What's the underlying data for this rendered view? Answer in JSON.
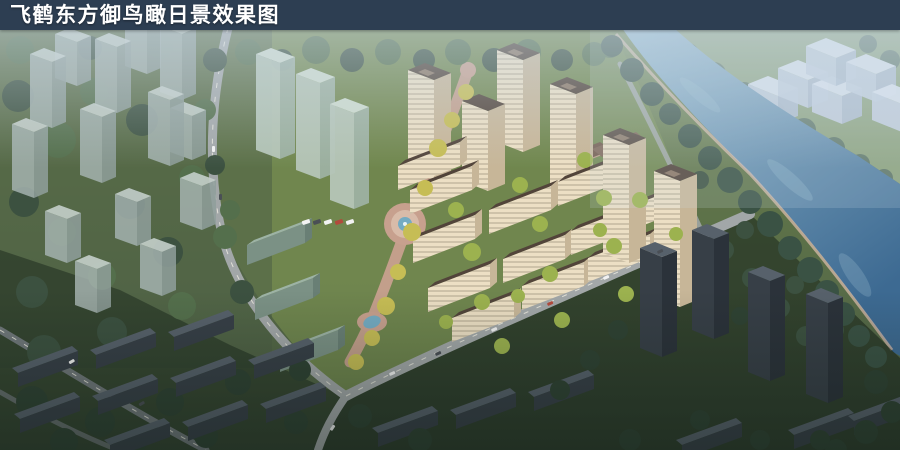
{
  "title_bar": {
    "text": "飞鹤东方御鸟瞰日景效果图"
  },
  "palette": {
    "titleBarBg": "#2d3e52",
    "titleText": "#ffffff",
    "riverLight": "#93b8cd",
    "riverDeep": "#3d6a92",
    "farBankGrass": "#8ba17b",
    "siteGrass": "#72884f",
    "contextGrass": "#4d5f45",
    "treeDark": "#3c5140",
    "treeMid": "#546f4c",
    "treeBright": "#9cb24f",
    "treeYellow": "#c6bd55",
    "treeDusk": "#2f4233",
    "treeHaze": "#5d7565",
    "treeBank": "#3a5244",
    "wallLit": "#ecdfc4",
    "wallShade": "#c7b698",
    "roofBrown": "#52443a",
    "roofTrim": "#8a7663",
    "clubRoof": "#6e5445",
    "clubRoofLight": "#7d6353",
    "glassFace": "#a3b1ad",
    "glassSide": "#8f9e9b",
    "glassTop": "#c2cdc8",
    "greenGlassFace": "#b6c6b9",
    "greenGlassSide": "#9db1a4",
    "greenGlassTop": "#ccdacc",
    "tealRoof": "#9db3a5",
    "tealFace": "#7b9185",
    "tealEnd": "#697f75",
    "darkWall": "#373f47",
    "darkWallShade": "#2b323a",
    "darkRoof": "#57616b",
    "road": "#a2a7a8",
    "roadOuter": "#70777a",
    "marking": "#eceadf",
    "plaza": "#c7a08e",
    "plazaLight": "#d8bba9",
    "pool": "#74abc2",
    "massingFace": "#c2cedd",
    "massingSide": "#aebccf",
    "massingTop": "#dbe3ee",
    "hazeTint": "#ccdbe8",
    "carWhite": "#f2f2f2",
    "carDark": "#4a4f55",
    "carRed": "#b24a3c"
  }
}
